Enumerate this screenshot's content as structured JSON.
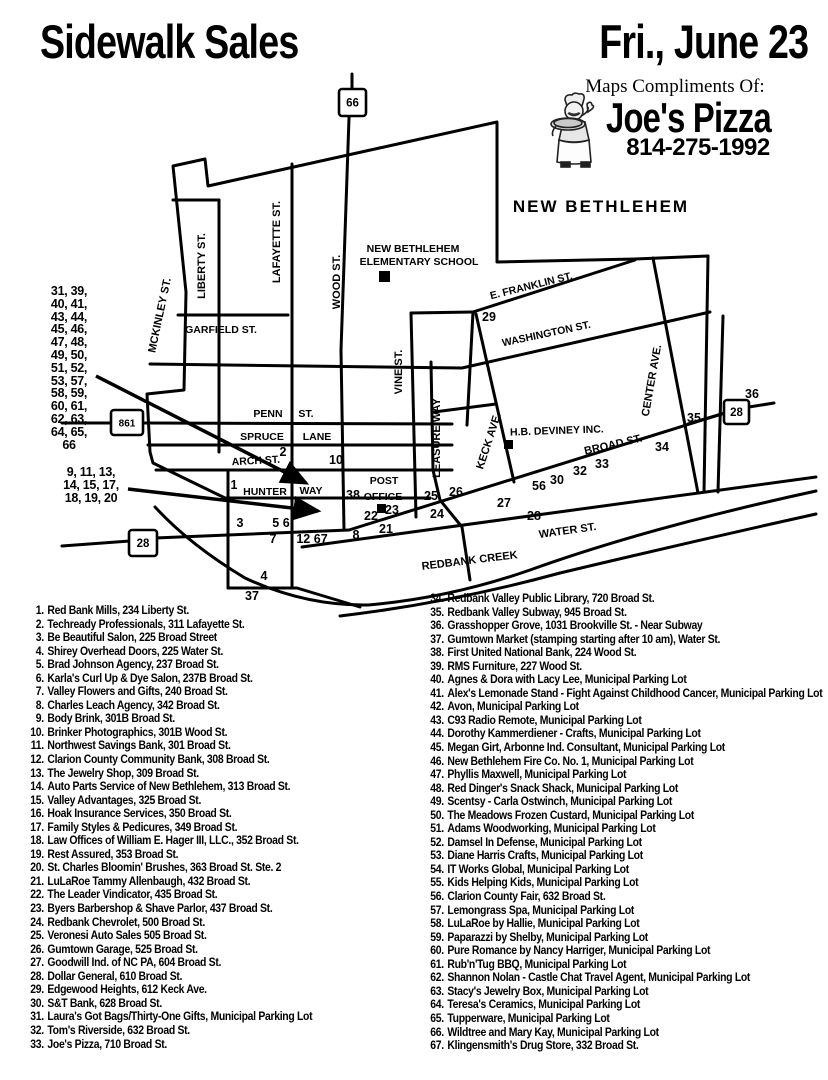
{
  "header": {
    "title": "Sidewalk Sales",
    "date": "Fri., June 23",
    "compliments": "Maps Compliments Of:",
    "sponsor": "Joe's Pizza",
    "phone": "814-275-1992"
  },
  "map": {
    "town_label": "NEW BETHLEHEM",
    "street_labels": [
      {
        "t": "MCKINLEY ST.",
        "x": 163,
        "y": 316,
        "r": -78,
        "s": 11
      },
      {
        "t": "LIBERTY ST.",
        "x": 205,
        "y": 266,
        "r": -90,
        "s": 11
      },
      {
        "t": "LAFAYETTE ST.",
        "x": 280,
        "y": 242,
        "r": -90,
        "s": 11
      },
      {
        "t": "WOOD ST.",
        "x": 340,
        "y": 282,
        "r": -90,
        "s": 11
      },
      {
        "t": "GARFIELD ST.",
        "x": 221,
        "y": 333,
        "r": 0,
        "s": 10.5
      },
      {
        "t": "VINE ST.",
        "x": 402,
        "y": 372,
        "r": -90,
        "s": 11
      },
      {
        "t": "LEASURE WAY",
        "x": 440,
        "y": 438,
        "r": -90,
        "s": 11
      },
      {
        "t": "KECK AVE.",
        "x": 492,
        "y": 442,
        "r": -72,
        "s": 11
      },
      {
        "t": "CENTER AVE.",
        "x": 655,
        "y": 381,
        "r": -80,
        "s": 11
      },
      {
        "t": "E. FRANKLIN ST.",
        "x": 532,
        "y": 289,
        "r": -14,
        "s": 10.5
      },
      {
        "t": "WASHINGTON ST.",
        "x": 547,
        "y": 337,
        "r": -12,
        "s": 10.5
      },
      {
        "t": "PENN",
        "x": 268,
        "y": 417,
        "r": 0,
        "s": 10.5
      },
      {
        "t": "ST.",
        "x": 306,
        "y": 417,
        "r": 0,
        "s": 10.5
      },
      {
        "t": "SPRUCE",
        "x": 262,
        "y": 440,
        "r": 0,
        "s": 10.5
      },
      {
        "t": "LANE",
        "x": 317,
        "y": 440,
        "r": 0,
        "s": 10.5
      },
      {
        "t": "ARCH ST.",
        "x": 256,
        "y": 464,
        "r": -3,
        "s": 10.5
      },
      {
        "t": "HUNTER",
        "x": 265,
        "y": 495,
        "r": 0,
        "s": 10.5
      },
      {
        "t": "WAY",
        "x": 311,
        "y": 494,
        "r": 0,
        "s": 10.5
      },
      {
        "t": "POST",
        "x": 384,
        "y": 484,
        "r": 0,
        "s": 10.5
      },
      {
        "t": "OFFICE",
        "x": 383,
        "y": 500,
        "r": 0,
        "s": 10.5
      },
      {
        "t": "H.B. DEVINEY INC.",
        "x": 557,
        "y": 434,
        "r": -2,
        "s": 10.5
      },
      {
        "t": "BROAD ST.",
        "x": 614,
        "y": 448,
        "r": -13,
        "s": 11
      },
      {
        "t": "WATER ST.",
        "x": 568,
        "y": 534,
        "r": -8,
        "s": 11
      },
      {
        "t": "REDBANK CREEK",
        "x": 470,
        "y": 564,
        "r": -7,
        "s": 11
      },
      {
        "t": "NEW BETHLEHEM",
        "x": 413,
        "y": 252,
        "r": 0,
        "s": 10.5
      },
      {
        "t": "ELEMENTARY SCHOOL",
        "x": 419,
        "y": 265,
        "r": 0,
        "s": 10.5
      }
    ],
    "numbers": [
      {
        "t": "29",
        "x": 489,
        "y": 321
      },
      {
        "t": "2",
        "x": 283,
        "y": 456
      },
      {
        "t": "10",
        "x": 336,
        "y": 464
      },
      {
        "t": "1",
        "x": 234,
        "y": 489
      },
      {
        "t": "38",
        "x": 353,
        "y": 499
      },
      {
        "t": "25",
        "x": 431,
        "y": 500
      },
      {
        "t": "26",
        "x": 456,
        "y": 496
      },
      {
        "t": "24",
        "x": 437,
        "y": 518
      },
      {
        "t": "23",
        "x": 392,
        "y": 514
      },
      {
        "t": "22",
        "x": 371,
        "y": 520
      },
      {
        "t": "21",
        "x": 386,
        "y": 533
      },
      {
        "t": "8",
        "x": 356,
        "y": 539
      },
      {
        "t": "3",
        "x": 240,
        "y": 527
      },
      {
        "t": "5 6",
        "x": 281,
        "y": 527
      },
      {
        "t": "7",
        "x": 273,
        "y": 543
      },
      {
        "t": "12 67",
        "x": 312,
        "y": 543
      },
      {
        "t": "4",
        "x": 264,
        "y": 580
      },
      {
        "t": "37",
        "x": 252,
        "y": 600
      },
      {
        "t": "27",
        "x": 504,
        "y": 507
      },
      {
        "t": "28",
        "x": 534,
        "y": 520
      },
      {
        "t": "56",
        "x": 539,
        "y": 490
      },
      {
        "t": "30",
        "x": 557,
        "y": 484
      },
      {
        "t": "32",
        "x": 580,
        "y": 475
      },
      {
        "t": "33",
        "x": 602,
        "y": 468
      },
      {
        "t": "34",
        "x": 662,
        "y": 451
      },
      {
        "t": "35",
        "x": 694,
        "y": 422
      },
      {
        "t": "36",
        "x": 752,
        "y": 398
      }
    ],
    "shields": [
      {
        "t": "66",
        "x": 339,
        "y": 89,
        "w": 27,
        "h": 27
      },
      {
        "t": "861",
        "x": 111,
        "y": 410,
        "w": 32,
        "h": 25
      },
      {
        "t": "28",
        "x": 129,
        "y": 530,
        "w": 28,
        "h": 26
      },
      {
        "t": "28",
        "x": 724,
        "y": 400,
        "w": 25,
        "h": 24
      }
    ],
    "clusters": {
      "group1": [
        "31, 39,",
        "40, 41,",
        "43, 44,",
        "45, 46,",
        "47, 48,",
        "49, 50,",
        "51, 52,",
        "53, 57,",
        "58, 59,",
        "60, 61,",
        "62, 63,",
        "64, 65,",
        "66"
      ],
      "group2": [
        "9, 11, 13,",
        "14, 15, 17,",
        "18, 19, 20"
      ]
    }
  },
  "directory": {
    "left_items": [
      {
        "n": "1.",
        "text": "Red Bank Mills, 234 Liberty St."
      },
      {
        "n": "2.",
        "text": "Techready Professionals, 311 Lafayette St."
      },
      {
        "n": "3.",
        "text": "Be Beautiful Salon, 225 Broad Street"
      },
      {
        "n": "4.",
        "text": "Shirey Overhead Doors, 225 Water St."
      },
      {
        "n": "5.",
        "text": "Brad Johnson Agency, 237 Broad St."
      },
      {
        "n": "6.",
        "text": "Karla's Curl Up & Dye Salon, 237B Broad St."
      },
      {
        "n": "7.",
        "text": "Valley Flowers and Gifts, 240 Broad St."
      },
      {
        "n": "8.",
        "text": "Charles Leach Agency, 342 Broad St."
      },
      {
        "n": "9.",
        "text": "Body Brink, 301B Broad St."
      },
      {
        "n": "10.",
        "text": "Brinker Photographics, 301B Wood St."
      },
      {
        "n": "11.",
        "text": "Northwest Savings Bank, 301 Broad St."
      },
      {
        "n": "12.",
        "text": "Clarion County Community Bank, 308 Broad St."
      },
      {
        "n": "13.",
        "text": "The Jewelry Shop, 309 Broad St."
      },
      {
        "n": "14.",
        "text": "Auto Parts Service of New Bethlehem, 313 Broad St."
      },
      {
        "n": "15.",
        "text": "Valley Advantages, 325 Broad St."
      },
      {
        "n": "16.",
        "text": "Hoak Insurance Services, 350 Broad St."
      },
      {
        "n": "17.",
        "text": "Family Styles & Pedicures, 349 Broad St."
      },
      {
        "n": "18.",
        "text": "Law Offices of William E. Hager III, LLC., 352 Broad St."
      },
      {
        "n": "19.",
        "text": "Rest Assured, 353 Broad St."
      },
      {
        "n": "20.",
        "text": "St. Charles Bloomin' Brushes, 363 Broad St. Ste. 2"
      },
      {
        "n": "21.",
        "text": "LuLaRoe Tammy Allenbaugh, 432 Broad St."
      },
      {
        "n": "22.",
        "text": "The Leader Vindicator, 435 Broad St."
      },
      {
        "n": "23.",
        "text": "Byers Barbershop & Shave Parlor, 437 Broad St."
      },
      {
        "n": "24.",
        "text": "Redbank Chevrolet, 500 Broad St."
      },
      {
        "n": "25.",
        "text": "Veronesi Auto Sales 505 Broad St."
      },
      {
        "n": "26.",
        "text": "Gumtown Garage, 525 Broad St."
      },
      {
        "n": "27.",
        "text": "Goodwill Ind. of NC PA, 604 Broad St."
      },
      {
        "n": "28.",
        "text": "Dollar General, 610 Broad St."
      },
      {
        "n": "29.",
        "text": "Edgewood Heights, 612 Keck Ave."
      },
      {
        "n": "30.",
        "text": "S&T Bank, 628 Broad St."
      },
      {
        "n": "31.",
        "text": "Laura's Got Bags/Thirty-One Gifts, Municipal Parking Lot"
      },
      {
        "n": "32.",
        "text": "Tom's Riverside, 632 Broad St."
      },
      {
        "n": "33.",
        "text": "Joe's Pizza, 710 Broad St."
      }
    ],
    "right_items": [
      {
        "n": "34.",
        "text": "Redbank Valley Public Library, 720 Broad St."
      },
      {
        "n": "35.",
        "text": "Redbank Valley Subway, 945 Broad St."
      },
      {
        "n": "36.",
        "text": "Grasshopper Grove, 1031 Brookville St. - Near Subway"
      },
      {
        "n": "37.",
        "text": "Gumtown Market (stamping starting after 10 am), Water St."
      },
      {
        "n": "38.",
        "text": "First United National Bank, 224 Wood St."
      },
      {
        "n": "39.",
        "text": "RMS Furniture, 227 Wood St."
      },
      {
        "n": "40.",
        "text": "Agnes & Dora with Lacy Lee, Municipal Parking Lot"
      },
      {
        "n": "41.",
        "text": "Alex's Lemonade Stand - Fight Against Childhood Cancer, Municipal Parking Lot"
      },
      {
        "n": "42.",
        "text": "Avon, Municipal Parking Lot"
      },
      {
        "n": "43.",
        "text": "C93 Radio Remote, Municipal Parking Lot"
      },
      {
        "n": "44.",
        "text": "Dorothy Kammerdiener - Crafts, Municipal Parking Lot"
      },
      {
        "n": "45.",
        "text": "Megan Girt, Arbonne Ind. Consultant, Municipal Parking Lot"
      },
      {
        "n": "46.",
        "text": "New Bethlehem Fire Co. No. 1, Municipal Parking Lot"
      },
      {
        "n": "47.",
        "text": "Phyllis Maxwell, Municipal Parking Lot"
      },
      {
        "n": "48.",
        "text": "Red Dinger's Snack Shack, Municipal Parking Lot"
      },
      {
        "n": "49.",
        "text": "Scentsy - Carla Ostwinch, Municipal Parking Lot"
      },
      {
        "n": "50.",
        "text": "The Meadows Frozen Custard, Municipal Parking Lot"
      },
      {
        "n": "51.",
        "text": "Adams Woodworking, Municipal Parking Lot"
      },
      {
        "n": "52.",
        "text": "Damsel In Defense, Municipal Parking Lot"
      },
      {
        "n": "53.",
        "text": "Diane Harris Crafts, Municipal Parking Lot"
      },
      {
        "n": "54.",
        "text": "IT Works Global, Municipal Parking Lot"
      },
      {
        "n": "55.",
        "text": "Kids Helping Kids, Municipal Parking Lot"
      },
      {
        "n": "56.",
        "text": "Clarion County Fair, 632 Broad St."
      },
      {
        "n": "57.",
        "text": "Lemongrass Spa, Municipal Parking Lot"
      },
      {
        "n": "58.",
        "text": "LuLaRoe by Hallie, Municipal Parking Lot"
      },
      {
        "n": "59.",
        "text": "Paparazzi by Shelby, Municipal Parking Lot"
      },
      {
        "n": "60.",
        "text": "Pure Romance by Nancy Harriger, Municipal Parking Lot"
      },
      {
        "n": "61.",
        "text": "Rub'n'Tug BBQ, Municipal Parking Lot"
      },
      {
        "n": "62.",
        "text": "Shannon Nolan - Castle Chat Travel Agent, Municipal Parking Lot"
      },
      {
        "n": "63.",
        "text": "Stacy's Jewelry Box, Municipal Parking Lot"
      },
      {
        "n": "64.",
        "text": "Teresa's Ceramics, Municipal Parking Lot"
      },
      {
        "n": "65.",
        "text": "Tupperware, Municipal Parking Lot"
      },
      {
        "n": "66.",
        "text": "Wildtree and Mary Kay, Municipal Parking Lot"
      },
      {
        "n": "67.",
        "text": "Klingensmith's Drug Store, 332 Broad St."
      }
    ]
  }
}
